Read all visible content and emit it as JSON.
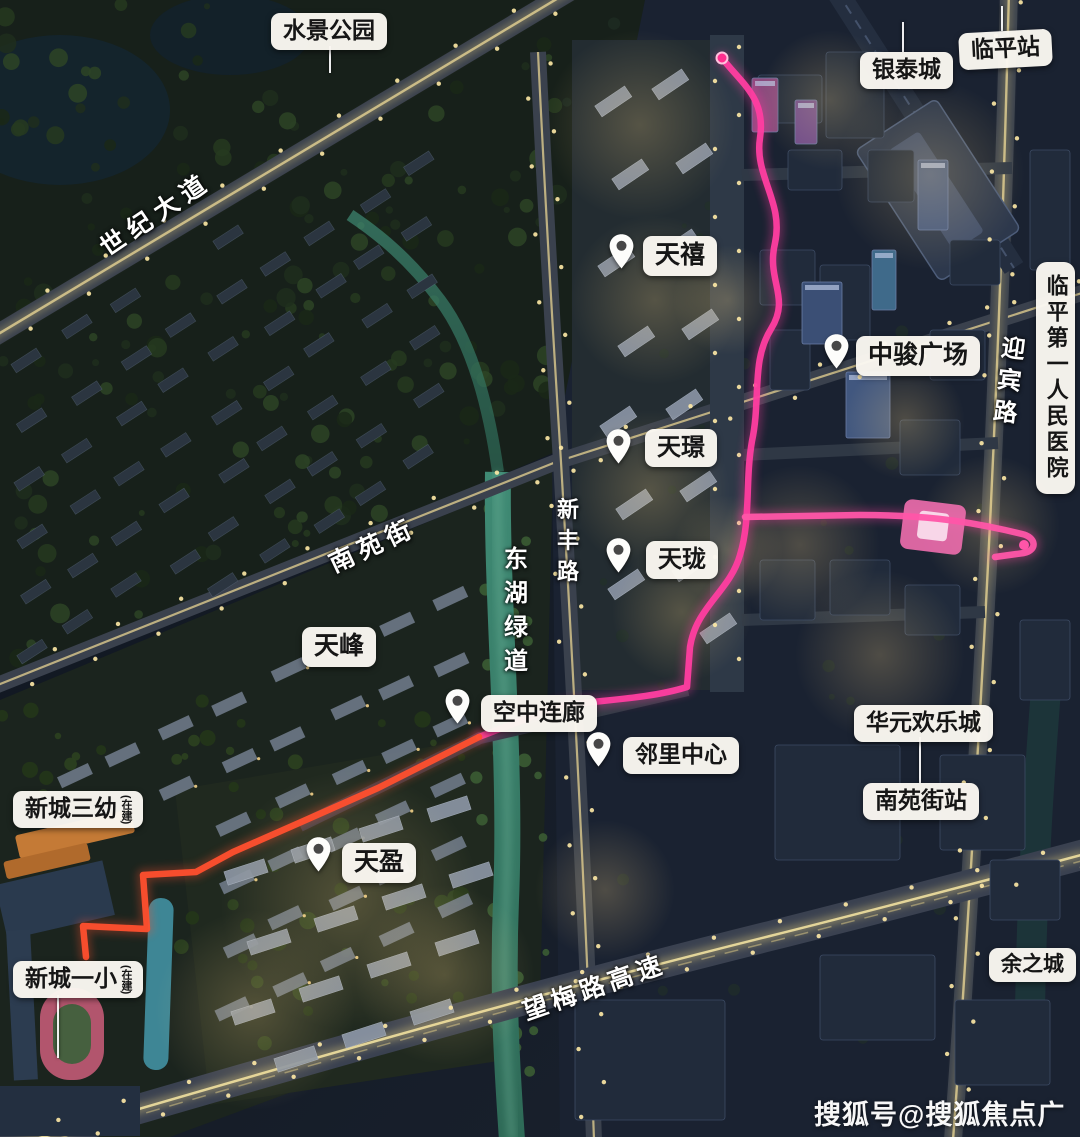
{
  "watermark": {
    "text": "搜狐号@搜狐焦点广安站"
  },
  "colors": {
    "route_pink": "#ff3da0",
    "route_orange": "#ff4f2e",
    "label_bg": "#faf7f1",
    "label_text": "#161616",
    "road_light": "#ddcb8f",
    "river_teal": "#3f8a74"
  },
  "labels": {
    "places": [
      {
        "id": "shuijing-park",
        "text": "水景公园",
        "x": 271,
        "y": 13,
        "fs": 23,
        "leader": {
          "x": 329,
          "y1": 46,
          "y2": 73
        }
      },
      {
        "id": "yintai-city",
        "text": "银泰城",
        "x": 860,
        "y": 52,
        "fs": 23,
        "leader": {
          "x": 902,
          "y1": 22,
          "y2": 52
        }
      },
      {
        "id": "linping-station",
        "text": "临平站",
        "x": 959,
        "y": 31,
        "fs": 23,
        "rotate": -3,
        "leader": {
          "x": 1001,
          "y1": 6,
          "y2": 31
        }
      },
      {
        "id": "tianfeng",
        "text": "天峰",
        "x": 302,
        "y": 627,
        "fs": 25
      },
      {
        "id": "huayuan-joy-city",
        "text": "华元欢乐城",
        "x": 854,
        "y": 705,
        "fs": 23
      },
      {
        "id": "nanyuan-street-station",
        "text": "南苑街站",
        "x": 863,
        "y": 783,
        "fs": 23,
        "leader": {
          "x": 919,
          "y1": 737,
          "y2": 783
        }
      },
      {
        "id": "yuzhicheng",
        "text": "余之城",
        "x": 989,
        "y": 948,
        "fs": 21
      },
      {
        "id": "xincheng-no3-kindergarten",
        "text": "新城三幼",
        "x": 13,
        "y": 791,
        "fs": 23,
        "suffix": "(在建)"
      },
      {
        "id": "xincheng-no1-primary",
        "text": "新城一小",
        "x": 13,
        "y": 961,
        "fs": 23,
        "suffix": "(在建)",
        "leader": {
          "x": 57,
          "y1": 995,
          "y2": 1058
        }
      },
      {
        "id": "linping-first-peoples-hospital",
        "text": "临平第一人民医院",
        "x": 1036,
        "y": 262,
        "fs": 22,
        "vertical": true
      }
    ],
    "pins": [
      {
        "id": "tianxi",
        "text": "天禧",
        "px": 608,
        "py": 233,
        "x": 643,
        "y": 236,
        "fs": 25
      },
      {
        "id": "zhongjun-plaza",
        "text": "中骏广场",
        "px": 823,
        "py": 333,
        "x": 856,
        "y": 336,
        "fs": 25
      },
      {
        "id": "tianjing",
        "text": "天璟",
        "px": 605,
        "py": 428,
        "x": 645,
        "y": 429,
        "fs": 24
      },
      {
        "id": "tianlong",
        "text": "天珑",
        "px": 605,
        "py": 537,
        "x": 646,
        "y": 541,
        "fs": 24
      },
      {
        "id": "sky-corridor",
        "text": "空中连廊",
        "px": 444,
        "py": 688,
        "x": 481,
        "y": 695,
        "fs": 23
      },
      {
        "id": "neighborhood-center",
        "text": "邻里中心",
        "px": 585,
        "py": 731,
        "x": 623,
        "y": 737,
        "fs": 23
      },
      {
        "id": "tianying",
        "text": "天盈",
        "px": 305,
        "py": 836,
        "x": 342,
        "y": 843,
        "fs": 25
      }
    ],
    "roads": [
      {
        "id": "shiji-avenue",
        "text": "世纪大道",
        "x": 155,
        "y": 213,
        "rotate": -34,
        "fs": 25,
        "spacing": 7
      },
      {
        "id": "nanyuan-street",
        "text": "南苑街",
        "x": 372,
        "y": 544,
        "rotate": -25,
        "fs": 25,
        "spacing": 6
      },
      {
        "id": "xinfeng-road",
        "text": "新丰路",
        "x": 566,
        "y": 544,
        "vertical": true,
        "fs": 22,
        "spacing": 9
      },
      {
        "id": "donghu-greenway",
        "text": "东湖绿道",
        "x": 513,
        "y": 614,
        "vertical": true,
        "fs": 24,
        "spacing": 10
      },
      {
        "id": "yingbin-road",
        "text": "迎宾路",
        "x": 1006,
        "y": 383,
        "vertical": true,
        "rotate": 7,
        "fs": 24,
        "spacing": 8
      },
      {
        "id": "wangmei-expressway",
        "text": "望梅路高速",
        "x": 594,
        "y": 986,
        "rotate": -19,
        "fs": 25,
        "spacing": 5
      }
    ]
  }
}
